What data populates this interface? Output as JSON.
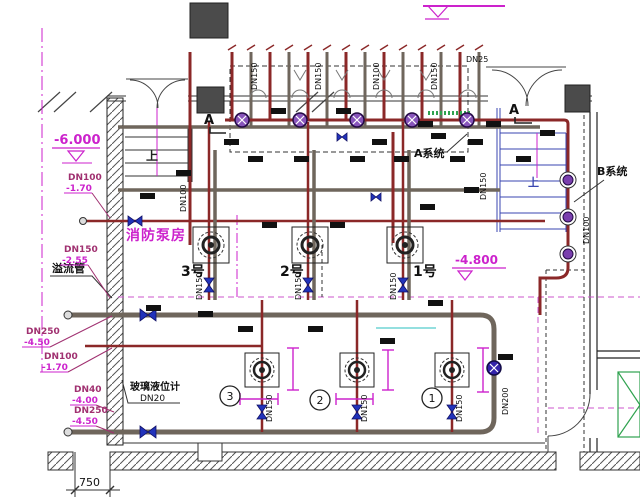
{
  "title": {
    "room": "消防泵房"
  },
  "elevations": {
    "left": "-6.000",
    "right": "-4.800"
  },
  "systems": {
    "a": "A系统",
    "b": "B系统"
  },
  "pumps": {
    "no3": "3号",
    "no2": "2号",
    "no1": "1号"
  },
  "circled_numbers": {
    "n3": "3",
    "n2": "2",
    "n1": "1"
  },
  "stairs": {
    "up_left": "上",
    "up_right": "上"
  },
  "sections": {
    "top": "A",
    "right": "A"
  },
  "annotations": {
    "overflow": "溢流管",
    "gauge": "玻璃液位计",
    "gauge_dn": "DN20"
  },
  "dimensions": {
    "footing": "750"
  },
  "left_tags": [
    {
      "dn": "DN100",
      "elev": "-1.70"
    },
    {
      "dn": "DN150",
      "elev": "-2.55"
    },
    {
      "dn": "DN250",
      "elev": "-4.50"
    },
    {
      "dn": "DN100",
      "elev": "-1.70"
    },
    {
      "dn": "DN40",
      "elev": "-4.00"
    },
    {
      "dn": "DN250",
      "elev": "-4.50"
    }
  ],
  "pipe_labels": {
    "stair_pipe": "DN100",
    "riser1": "DN150",
    "riser2": "DN150",
    "riser3": "DN100",
    "riser4": "DN150",
    "small_branch": "DN25",
    "right_a": "DN150",
    "p3": "DN150",
    "p2": "DN150",
    "p1": "DN150",
    "b3": "DN150",
    "b2": "DN150",
    "b1": "DN150",
    "bottom_right": "DN200",
    "right_edge": "DN100"
  },
  "colors": {
    "magenta": "#cc22cc",
    "tag_dn": "#a03070",
    "pipe_red": "#8b2828",
    "pipe_gray": "#6f665c",
    "valve_blue": "#2233bb",
    "stair_blue": "#3946b0",
    "green": "#2fa24f"
  }
}
